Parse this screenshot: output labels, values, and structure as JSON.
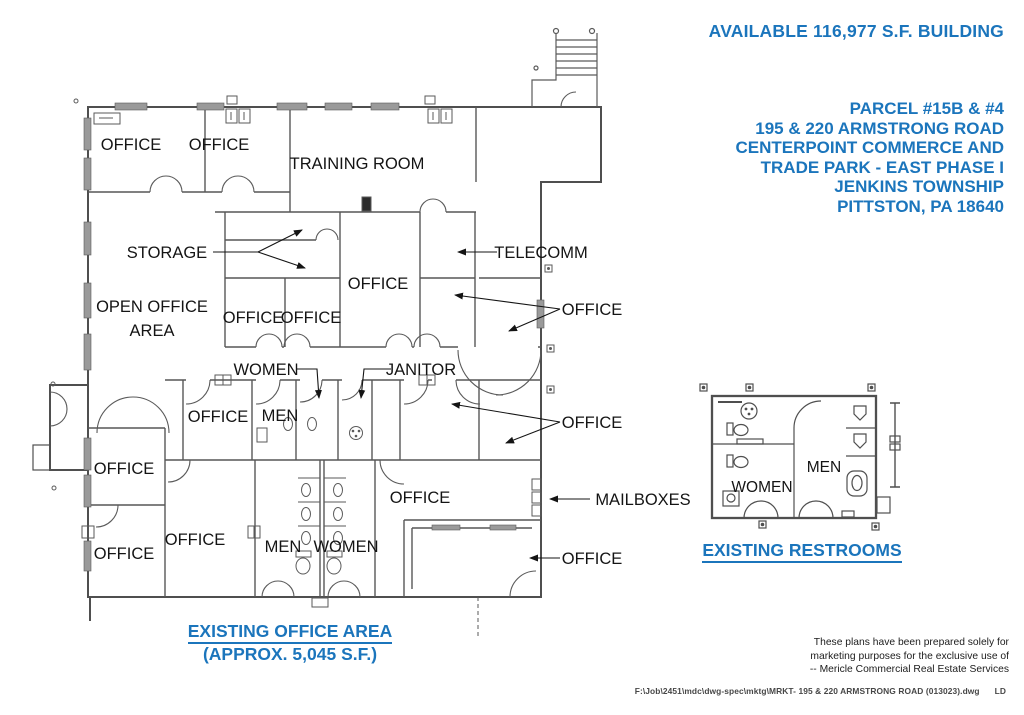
{
  "colors": {
    "accent_blue": "#1b75bc",
    "ink": "#141414",
    "wall_gray": "#575757"
  },
  "header": {
    "available_text": "AVAILABLE 116,977 S.F. BUILDING"
  },
  "address_block": {
    "lines": [
      "PARCEL #15B & #4",
      "195 & 220 ARMSTRONG ROAD",
      "CENTERPOINT COMMERCE AND",
      "TRADE PARK - EAST PHASE I",
      "JENKINS TOWNSHIP",
      "PITTSTON, PA 18640"
    ]
  },
  "floor_plan": {
    "labels": {
      "office_top_1": "OFFICE",
      "office_top_2": "OFFICE",
      "training_room": "TRAINING ROOM",
      "storage": "STORAGE",
      "telecomm": "TELECOMM",
      "open_office_line1": "OPEN OFFICE",
      "open_office_line2": "AREA",
      "office_mid_left_1": "OFFICE",
      "office_mid_left_2": "OFFICE",
      "office_center": "OFFICE",
      "office_right_upper": "OFFICE",
      "women_upper": "WOMEN",
      "janitor": "JANITOR",
      "office_west_upper": "OFFICE",
      "men_upper": "MEN",
      "office_right_mid": "OFFICE",
      "office_west_1": "OFFICE",
      "office_lower_center": "OFFICE",
      "mailboxes": "MAILBOXES",
      "office_sw_inner": "OFFICE",
      "office_west_2": "OFFICE",
      "men_lower": "MEN",
      "women_lower": "WOMEN",
      "office_right_lower": "OFFICE"
    },
    "caption": {
      "line1": "EXISTING OFFICE AREA",
      "line2": "(APPROX. 5,045 S.F.)"
    }
  },
  "restroom_detail": {
    "women": "WOMEN",
    "men": "MEN",
    "caption": "EXISTING RESTROOMS"
  },
  "disclaimer": {
    "lines": [
      "These plans have been prepared solely for",
      "marketing purposes for the exclusive use of",
      "-- Mericle Commercial Real Estate Services"
    ]
  },
  "footer": {
    "file_path": "F:\\Job\\2451\\mdc\\dwg-spec\\mktg\\MRKT- 195 & 220 ARMSTRONG ROAD (013023).dwg",
    "initials": "LD"
  }
}
